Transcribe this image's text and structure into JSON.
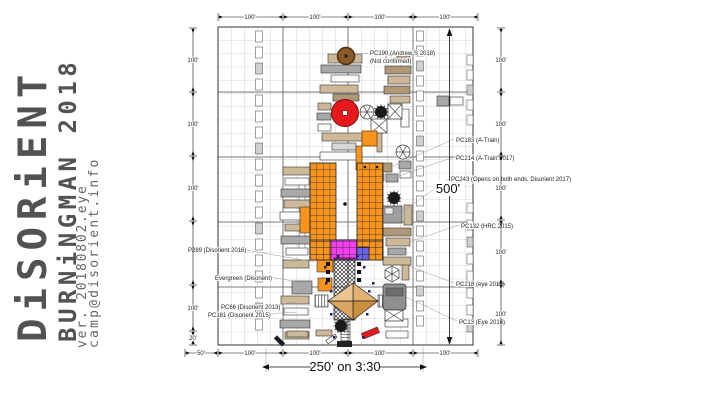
{
  "branding": {
    "title": "DiSORiENT",
    "subtitle": "BURNiNGMAN 2018",
    "version": "ver. 20180802.eye",
    "email": "camp@disorient.info"
  },
  "plan": {
    "rulers": {
      "top": [
        "100'",
        "100'",
        "100'",
        "100'"
      ],
      "bottom": [
        "50'",
        "100'",
        "100'",
        "100'",
        "100'"
      ],
      "left": [
        "100'",
        "100'",
        "100'",
        "100'",
        "20'"
      ],
      "right": [
        "100'",
        "100'",
        "100'",
        "100'",
        "100'"
      ]
    },
    "dimensions": {
      "height_label": "500'",
      "width_label": "250' on 3:30"
    },
    "labels": {
      "pc190_line1": "PC190 (Andrew S 2018)",
      "pc190_line2": "(Not confirmed)",
      "pc183": "PC183 (A-Train)",
      "pc214": "PC214 (A-Train 2017)",
      "pc243": "PC243 (Opens on both ends, Disorient 2017)",
      "pc132": "PC132 (HRC 2015)",
      "pc218": "PC218 (eye 2015)",
      "pc13": "PC13 (Eye 2016)",
      "p289": "P289 (Disorient 2016)",
      "evergreen": "Evergreen (Disorient)",
      "pc66": "PC66 (Disorient 2013)",
      "pc181": "PC181 (Disorient 2015)"
    },
    "colors": {
      "container_orange": "#F7941D",
      "magenta": "#F23FF0",
      "violet": "#6863E8",
      "red": "#E8191C",
      "brown": "#8A5A28",
      "wood": "#D9A05B",
      "tan": "#CDB998",
      "gray": "#A8A8A8"
    },
    "strips": [
      {
        "x": 259,
        "y1": 31,
        "y2": 340,
        "step": 16,
        "w": 7,
        "h": 11
      },
      {
        "x": 302,
        "y1": 183,
        "y2": 256,
        "step": 12,
        "w": 6,
        "h": 8
      },
      {
        "x": 420,
        "y1": 31,
        "y2": 340,
        "step": 15,
        "w": 7,
        "h": 10
      },
      {
        "x": 470,
        "y1": 55,
        "y2": 133,
        "step": 15,
        "w": 6,
        "h": 10
      },
      {
        "x": 470,
        "y1": 203,
        "y2": 338,
        "step": 17,
        "w": 6,
        "h": 10
      }
    ],
    "trailers": [
      [
        328,
        54,
        34,
        9,
        "t"
      ],
      [
        321,
        65,
        40,
        8,
        "g"
      ],
      [
        331,
        75,
        28,
        7,
        "w"
      ],
      [
        320,
        85,
        38,
        8,
        "t"
      ],
      [
        333,
        94,
        26,
        7,
        "T"
      ],
      [
        318,
        103,
        13,
        7,
        "t"
      ],
      [
        317,
        113,
        14,
        7,
        "g"
      ],
      [
        318,
        124,
        13,
        7,
        "w"
      ],
      [
        322,
        133,
        40,
        8,
        "t"
      ],
      [
        332,
        143,
        24,
        7,
        "s"
      ],
      [
        320,
        152,
        42,
        8,
        "w"
      ],
      [
        358,
        163,
        34,
        9,
        "T"
      ],
      [
        360,
        174,
        24,
        7,
        "w"
      ],
      [
        386,
        174,
        12,
        8,
        "g"
      ],
      [
        377,
        128,
        5,
        24,
        "t"
      ],
      [
        356,
        146,
        6,
        24,
        "o"
      ],
      [
        401,
        109,
        8,
        18,
        "w"
      ],
      [
        399,
        161,
        12,
        8,
        "g"
      ],
      [
        400,
        171,
        11,
        7,
        "w"
      ],
      [
        404,
        205,
        8,
        20,
        "t"
      ],
      [
        402,
        262,
        7,
        18,
        "t"
      ],
      [
        386,
        55,
        16,
        7,
        "w"
      ],
      [
        397,
        56,
        13,
        7,
        "t"
      ],
      [
        385,
        66,
        26,
        8,
        "T"
      ],
      [
        388,
        76,
        22,
        8,
        "t"
      ],
      [
        384,
        86,
        26,
        8,
        "T"
      ],
      [
        390,
        96,
        20,
        7,
        "t"
      ],
      [
        383,
        228,
        28,
        8,
        "T"
      ],
      [
        386,
        238,
        24,
        8,
        "t"
      ],
      [
        388,
        248,
        18,
        7,
        "g"
      ],
      [
        383,
        257,
        28,
        8,
        "t"
      ],
      [
        385,
        319,
        23,
        8,
        "w"
      ],
      [
        386,
        331,
        22,
        7,
        "w"
      ],
      [
        437,
        96,
        12,
        10,
        "g"
      ],
      [
        450,
        97,
        13,
        8,
        "w"
      ],
      [
        283,
        167,
        27,
        8,
        "t"
      ],
      [
        285,
        178,
        24,
        7,
        "w"
      ],
      [
        281,
        189,
        29,
        8,
        "g"
      ],
      [
        284,
        200,
        26,
        8,
        "t"
      ],
      [
        280,
        212,
        30,
        8,
        "w"
      ],
      [
        285,
        224,
        24,
        7,
        "t"
      ],
      [
        281,
        236,
        30,
        8,
        "g"
      ],
      [
        286,
        248,
        22,
        7,
        "w"
      ],
      [
        283,
        260,
        26,
        8,
        "t"
      ],
      [
        281,
        296,
        28,
        8,
        "t"
      ],
      [
        284,
        308,
        24,
        7,
        "w"
      ],
      [
        280,
        320,
        30,
        8,
        "g"
      ],
      [
        285,
        332,
        24,
        7,
        "t"
      ],
      [
        300,
        207,
        10,
        26,
        "o"
      ],
      [
        292,
        281,
        20,
        13,
        "g"
      ],
      [
        317,
        257,
        16,
        15,
        "o"
      ],
      [
        318,
        278,
        14,
        13,
        "o"
      ],
      [
        287,
        331,
        21,
        6,
        "t"
      ],
      [
        316,
        330,
        16,
        6,
        "t"
      ],
      [
        274,
        339,
        11,
        4,
        "k",
        45
      ],
      [
        326,
        337,
        11,
        4,
        "w",
        -35
      ],
      [
        362,
        330,
        17,
        6,
        "r",
        -22
      ]
    ],
    "dots": [
      [
        330,
        313
      ],
      [
        366,
        313
      ],
      [
        333,
        336
      ],
      [
        362,
        336
      ],
      [
        325,
        282
      ],
      [
        372,
        282
      ],
      [
        337,
        255
      ],
      [
        356,
        255
      ],
      [
        324,
        266
      ],
      [
        363,
        266
      ],
      [
        330,
        290
      ],
      [
        368,
        290
      ]
    ]
  }
}
